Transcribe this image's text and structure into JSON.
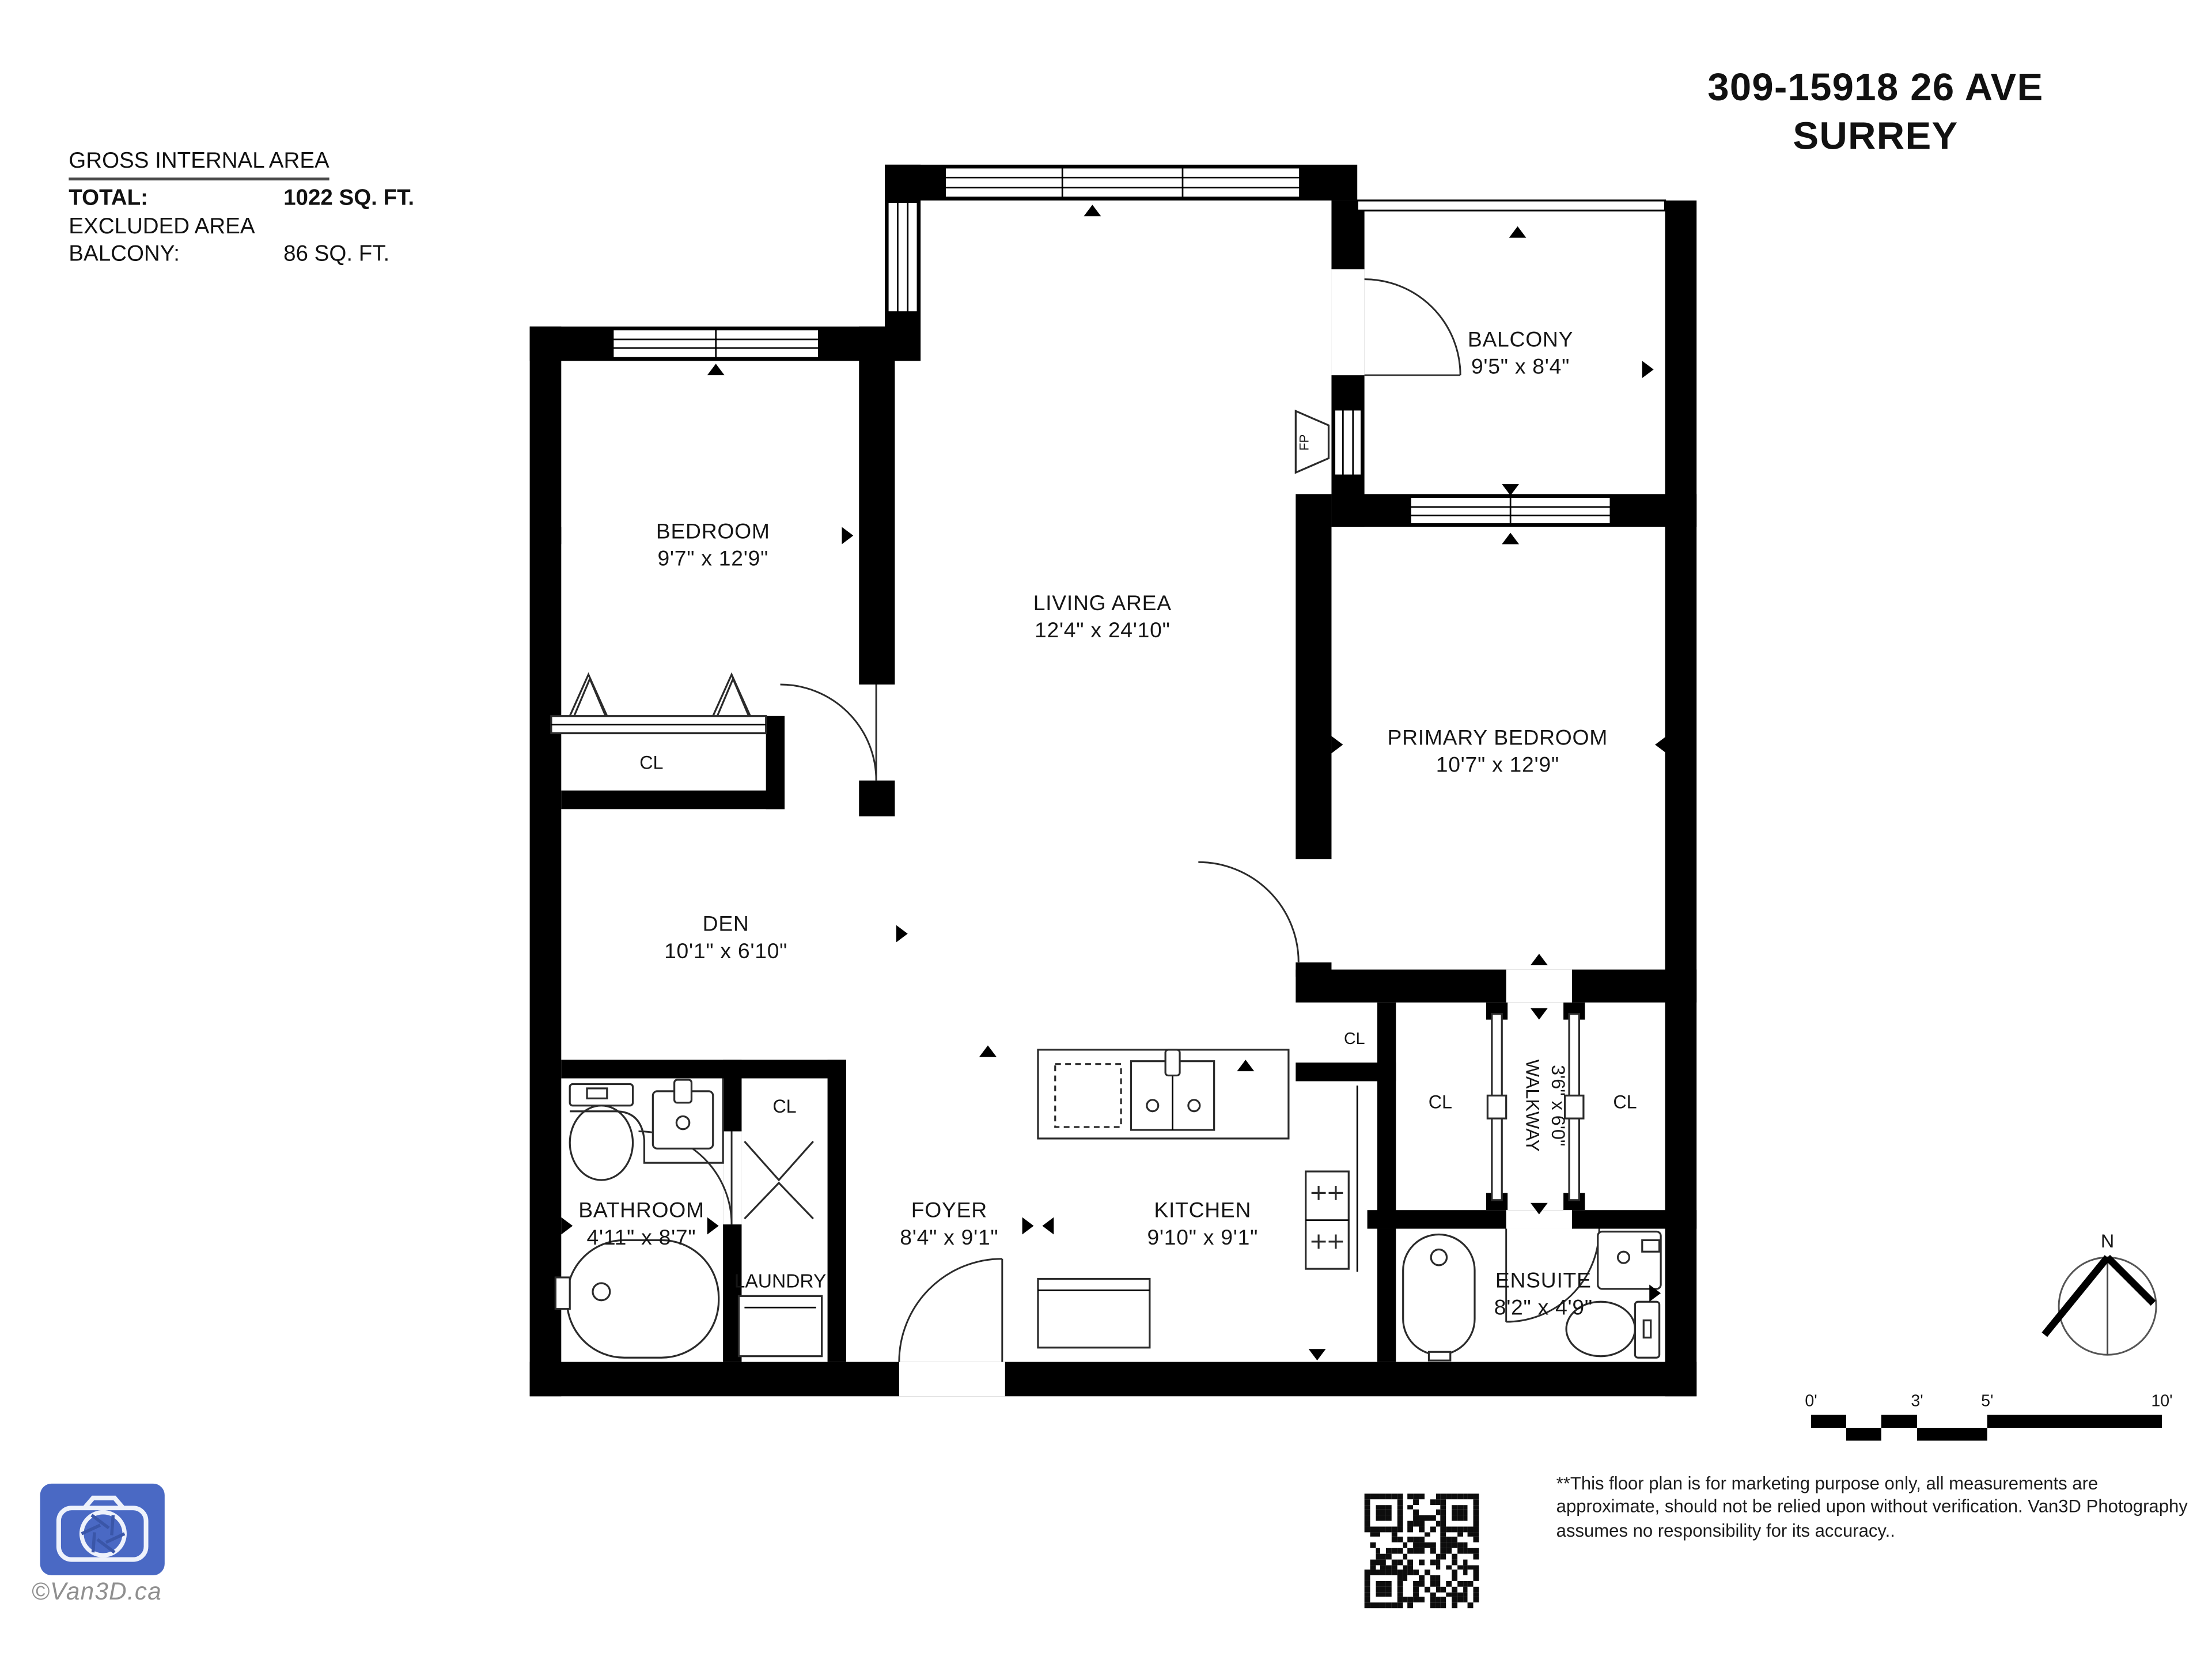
{
  "title": {
    "line1": "309-15918 26 AVE",
    "line2": "SURREY"
  },
  "area_summary": {
    "heading": "GROSS INTERNAL AREA",
    "rows": [
      {
        "label": "TOTAL:",
        "value": "1022 SQ. FT."
      },
      {
        "label": "EXCLUDED AREA",
        "value": ""
      },
      {
        "label": "BALCONY:",
        "value": "86 SQ. FT."
      }
    ]
  },
  "rooms": {
    "bedroom": {
      "name": "BEDROOM",
      "dims": "9'7\" x 12'9\""
    },
    "living": {
      "name": "LIVING AREA",
      "dims": "12'4\" x 24'10\""
    },
    "balcony": {
      "name": "BALCONY",
      "dims": "9'5\" x 8'4\""
    },
    "primary": {
      "name": "PRIMARY BEDROOM",
      "dims": "10'7\" x 12'9\""
    },
    "den": {
      "name": "DEN",
      "dims": "10'1\" x 6'10\""
    },
    "bathroom": {
      "name": "BATHROOM",
      "dims": "4'11\" x 8'7\""
    },
    "foyer": {
      "name": "FOYER",
      "dims": "8'4\" x 9'1\""
    },
    "kitchen": {
      "name": "KITCHEN",
      "dims": "9'10\" x 9'1\""
    },
    "ensuite": {
      "name": "ENSUITE",
      "dims": "8'2\" x 4'9\""
    },
    "walkway": {
      "name": "WALKWAY",
      "dims": "3'6\" x 6'0\""
    },
    "laundry": {
      "name": "LAUNDRY"
    },
    "closet_label": "CL",
    "fireplace_label": "FP"
  },
  "compass": {
    "north_label": "N"
  },
  "scale_bar": {
    "labels": [
      "0'",
      "3'",
      "5'",
      "10'"
    ]
  },
  "disclaimer": "**This floor plan is for marketing purpose only, all measurements are approximate, should not be relied upon without verification. Van3D Photography assumes no responsibility for its accuracy..",
  "watermark": "©Van3D.ca",
  "colors": {
    "logo_blue": "#4a69c4",
    "wall": "#000000"
  }
}
